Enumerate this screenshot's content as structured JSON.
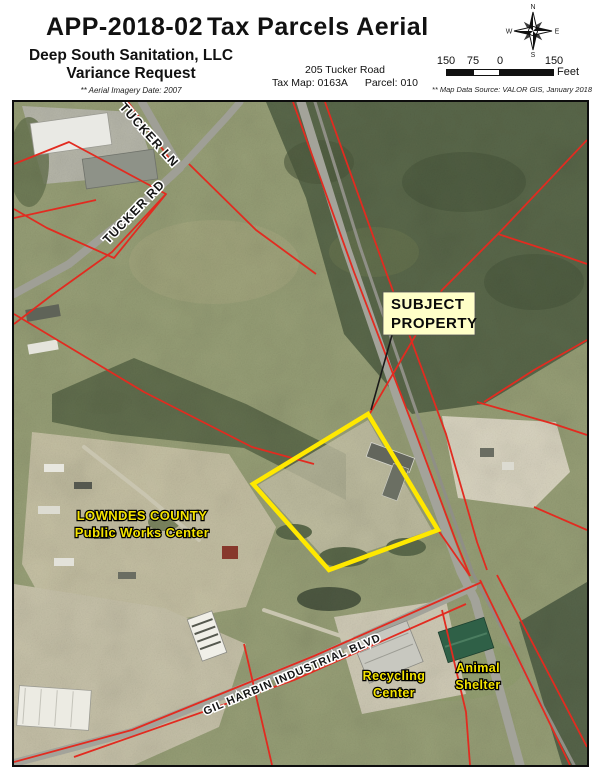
{
  "header": {
    "app_number": "APP-2018-02",
    "title": "Tax Parcels Aerial",
    "applicant": "Deep South Sanitation, LLC",
    "request_type": "Variance Request",
    "imagery_note": "** Aerial Imagery Date: 2007",
    "address": "205 Tucker Road",
    "tax_map": "Tax Map: 0163A",
    "parcel": "Parcel: 010"
  },
  "compass": {
    "n": "N",
    "e": "E",
    "s": "S",
    "w": "W"
  },
  "scale_bar": {
    "labels": [
      "150",
      "75",
      "0",
      "150"
    ],
    "unit": "Feet",
    "source_note": "** Map Data Source:  VALOR GIS, January 2018"
  },
  "map": {
    "road_labels": {
      "tucker_ln": "TUCKER LN",
      "tucker_rd": "TUCKER RD",
      "gil_harbin": "GIL HARBIN INDUSTRIAL BLVD"
    },
    "poi_labels": {
      "lowndes_line1": "LOWNDES COUNTY",
      "lowndes_line2": "Public Works Center",
      "recycling_line1": "Recycling",
      "recycling_line2": "Center",
      "animal_line1": "Animal",
      "animal_line2": "Shelter"
    },
    "callout": {
      "line1": "SUBJECT",
      "line2": "PROPERTY"
    },
    "colors": {
      "parcel_line": "#e22b20",
      "subject_outline": "#ffe800",
      "poi_text": "#f5e400",
      "callout_bg": "#ffffc8"
    }
  }
}
